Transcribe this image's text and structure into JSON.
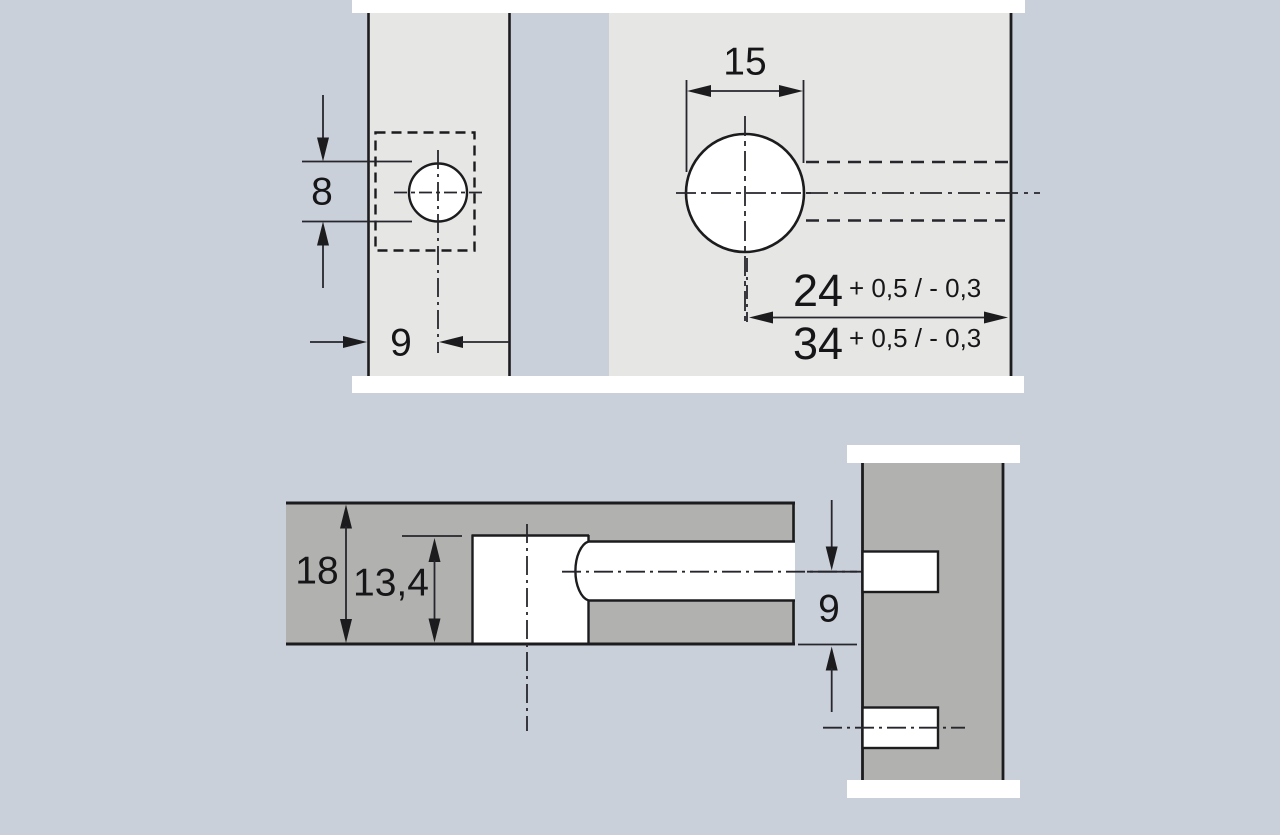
{
  "drawing": {
    "type": "technical-drilling-diagram",
    "colors": {
      "background": "#cad0d9",
      "panel_face": "#e6e6e5",
      "section_fill": "#b1b1b0",
      "outline": "#1c1c1e",
      "hole_fill": "#ffffff"
    },
    "top_view": {
      "door_hole": {
        "depth_label": "8",
        "offset_label": "9"
      },
      "cup_hole": {
        "diameter_label": "15",
        "dim_primary": {
          "value": "24",
          "tolerance": "+ 0,5 / - 0,3"
        },
        "dim_secondary": {
          "value": "34",
          "tolerance": "+ 0,5 / - 0,3"
        }
      }
    },
    "section_view": {
      "panel_thickness_label": "18",
      "drilling_depth_label": "13,4",
      "offset_label": "9"
    }
  }
}
